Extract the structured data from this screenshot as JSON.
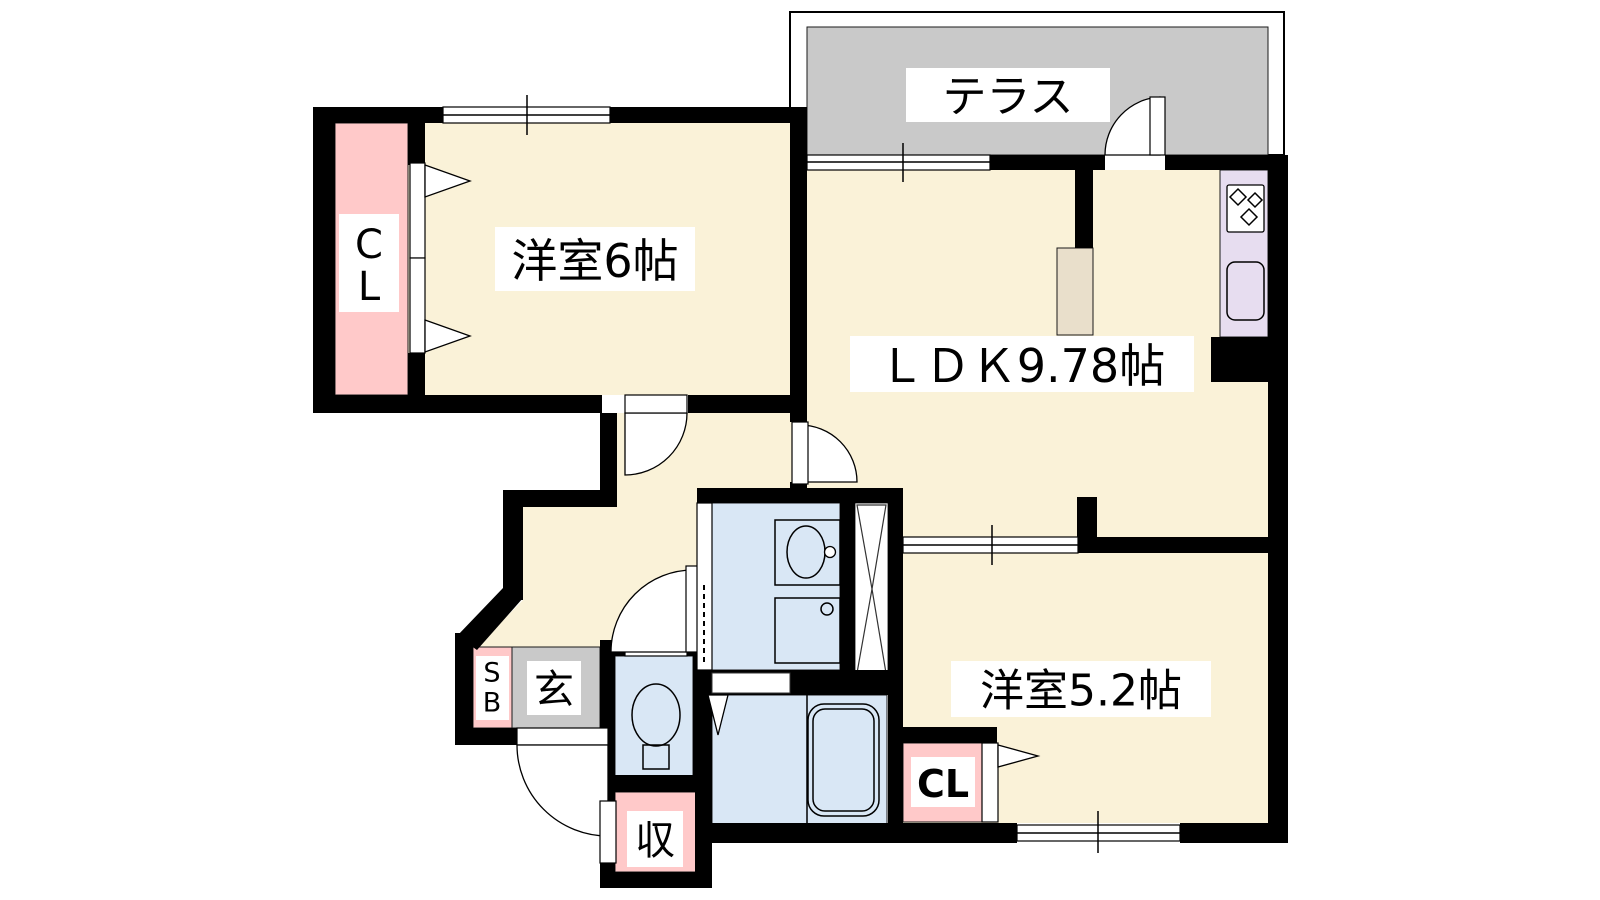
{
  "floorplan": {
    "labels": {
      "western_room_6": "洋室6帖",
      "ldk": "ＬＤＫ9.78帖",
      "western_room_5_2": "洋室5.2帖",
      "terrace": "テラス",
      "entrance": "玄",
      "storage": "収",
      "closet_5_2": "CL",
      "closet_6_line1": "C",
      "closet_6_line2": "L",
      "shoe_box_line1": "S",
      "shoe_box_line2": "B"
    },
    "colors": {
      "room_floor": "#FAF2D8",
      "closet_pink": "#FFC9C9",
      "terrace_gray": "#C9C9C9",
      "water_blue": "#D9E7F5",
      "kitchen_purple": "#E7DDF0",
      "counter_tan": "#E9DFCB",
      "wall_black": "#000000"
    },
    "icons": [
      "stove-icon",
      "kitchen-sink-icon",
      "vanity-sink-icon",
      "washer-pan-icon",
      "toilet-icon",
      "bathtub-icon",
      "shaft-cross-icon"
    ]
  }
}
